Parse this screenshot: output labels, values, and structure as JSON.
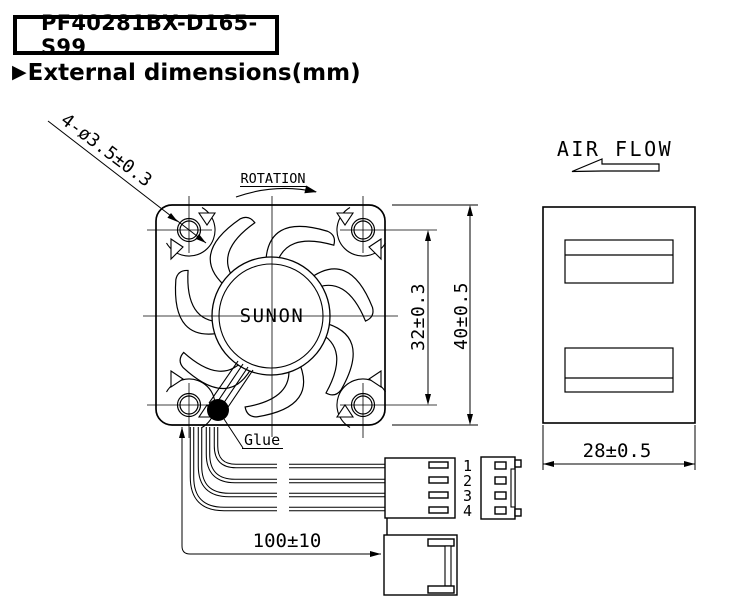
{
  "header": {
    "model": "PF40281BX-D165-S99",
    "section_marker": "▶",
    "section_title": "External dimensions(mm)"
  },
  "front_view": {
    "brand": "SUNON",
    "rotation_label": "ROTATION",
    "holes_callout": "4-ø3.5±0.3",
    "glue_label": "Glue",
    "hole_pitch_dim": "32±0.3",
    "frame_size_dim": "40±0.5",
    "lead_length_dim": "100±10"
  },
  "connector": {
    "pins": [
      "1",
      "2",
      "3",
      "4"
    ]
  },
  "side_view": {
    "air_flow_label": "AIR FLOW",
    "depth_dim": "28±0.5"
  },
  "colors": {
    "line": "#000000",
    "background": "#ffffff"
  }
}
